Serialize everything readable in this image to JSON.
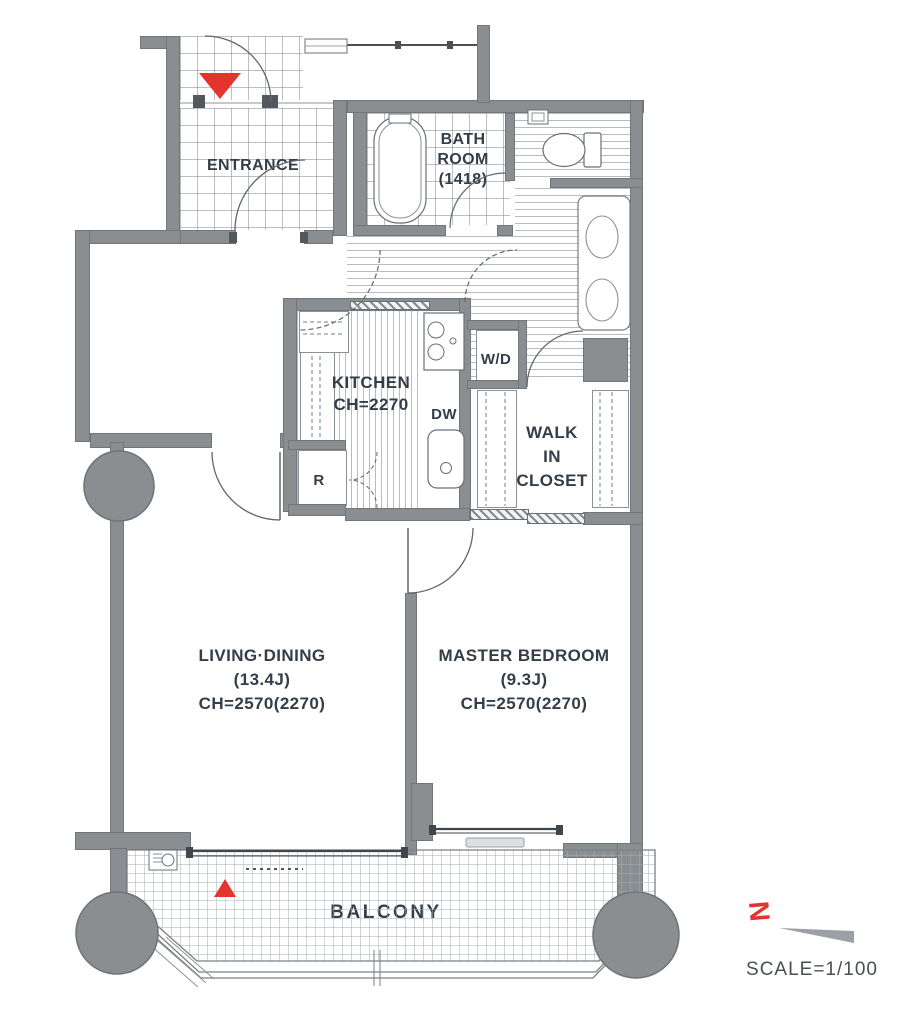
{
  "rooms": {
    "entrance": {
      "label": "ENTRANCE"
    },
    "bathroom": {
      "line1": "BATH",
      "line2": "ROOM",
      "line3": "(1418)"
    },
    "kitchen": {
      "name": "KITCHEN",
      "ceiling": "CH=2270"
    },
    "washer_dryer": {
      "label": "W/D"
    },
    "dishwasher": {
      "label": "DW"
    },
    "refrigerator": {
      "label": "R"
    },
    "walk_in_closet": {
      "line1": "WALK",
      "line2": "IN",
      "line3": "CLOSET"
    },
    "living_dining": {
      "name": "LIVING·DINING",
      "size": "(13.4J)",
      "ceiling": "CH=2570(2270)"
    },
    "master_bedroom": {
      "name": "MASTER BEDROOM",
      "size": "(9.3J)",
      "ceiling": "CH=2570(2270)"
    },
    "balcony": {
      "label": "BALCONY"
    }
  },
  "compass": {
    "north_label": "N"
  },
  "scale_note": "SCALE=1/100",
  "colors": {
    "wall": "#8A8E91",
    "accent_red": "#E5332D",
    "label_text": "#333E49"
  }
}
